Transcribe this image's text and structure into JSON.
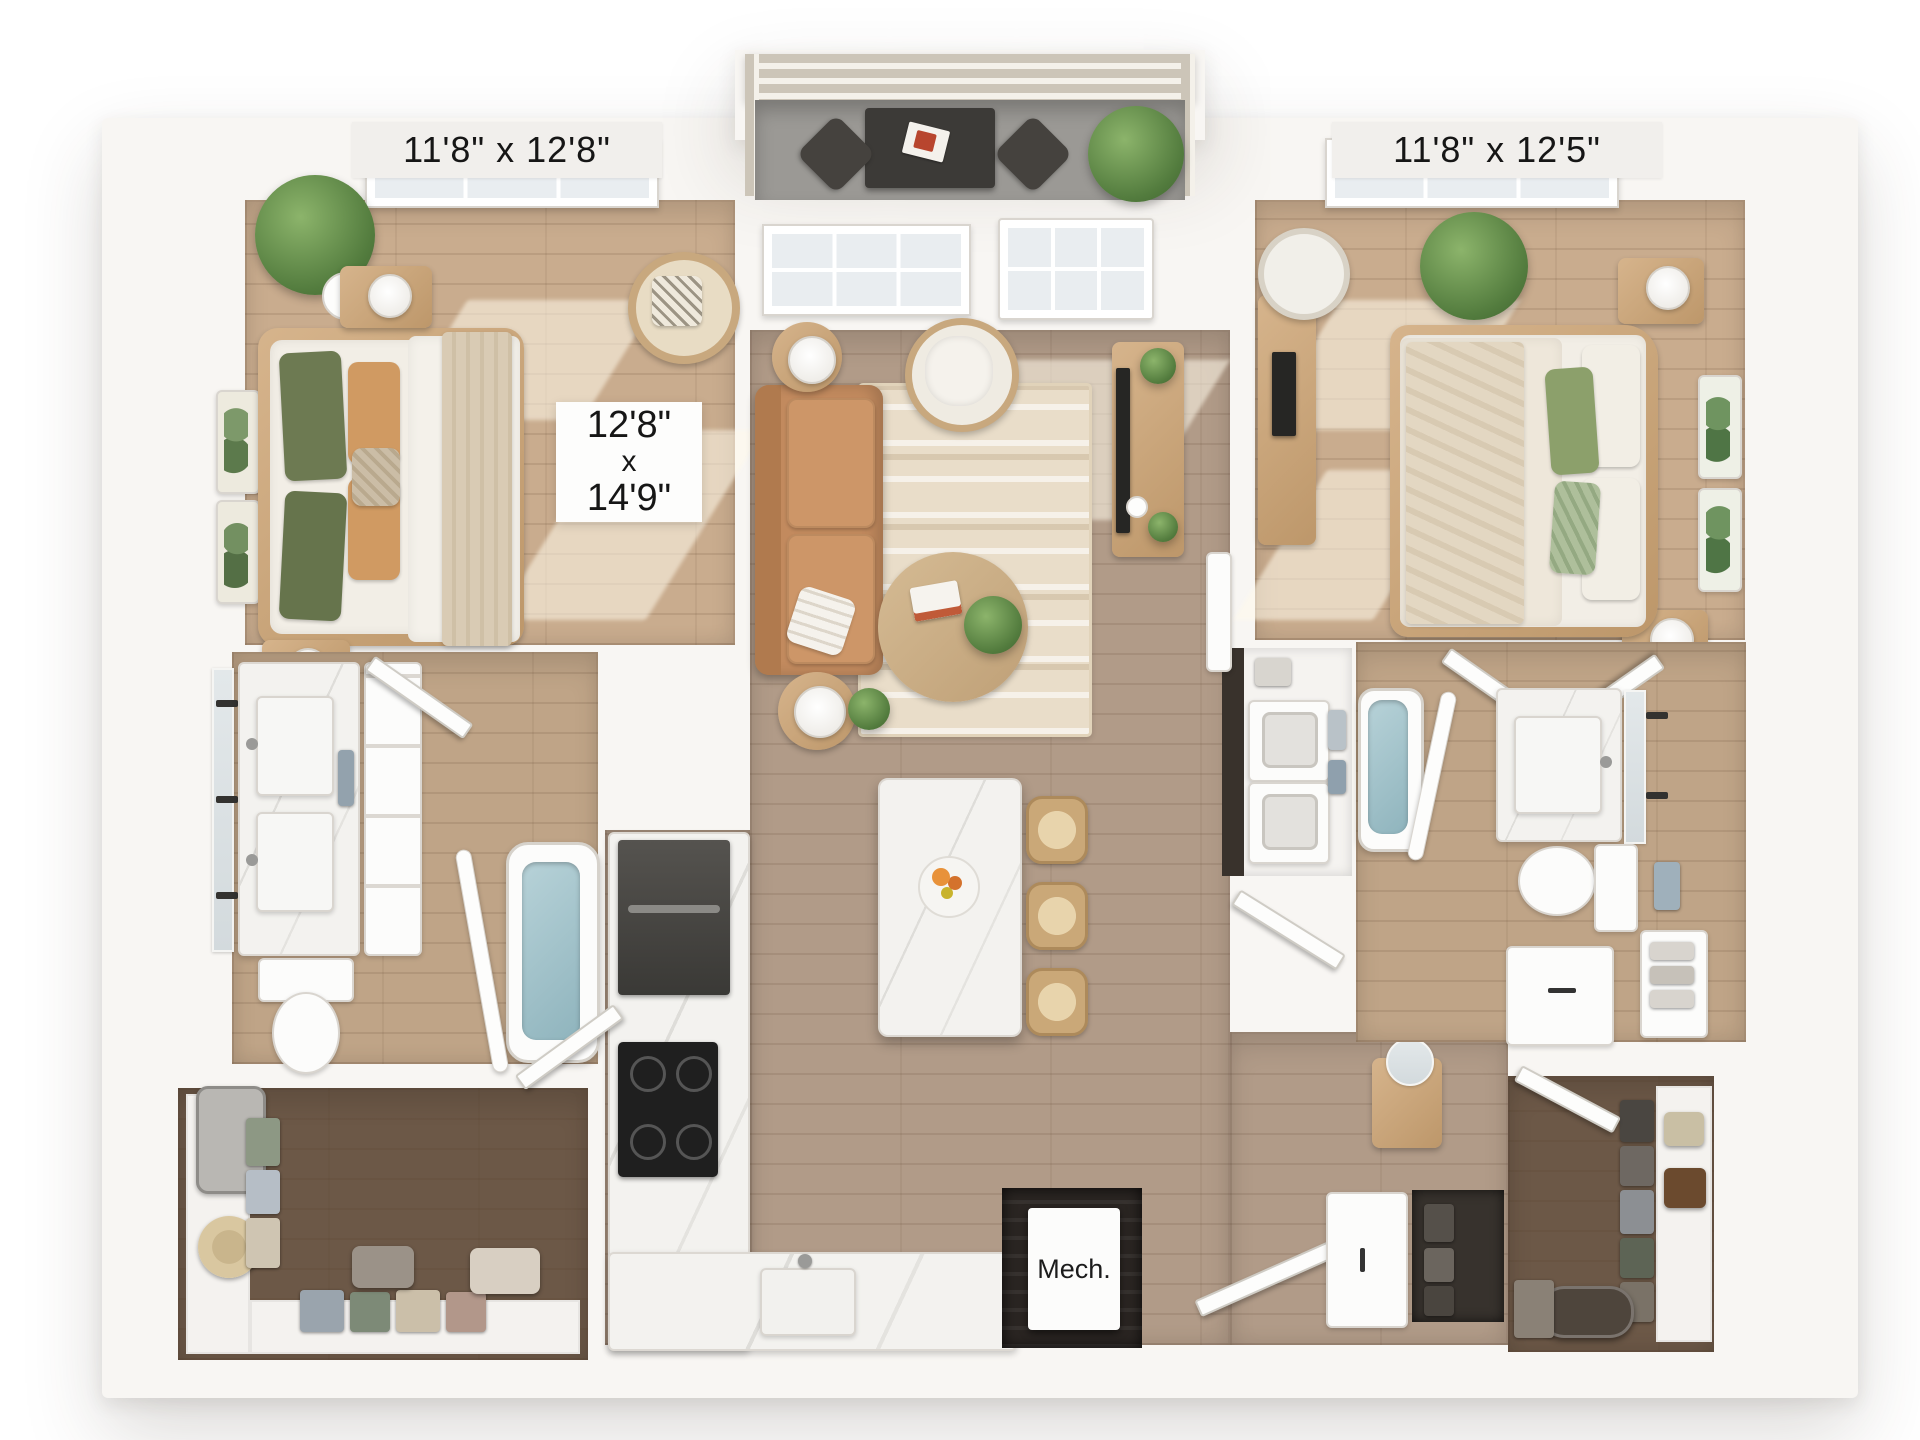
{
  "labels": {
    "bedroom_left_dims": "11'8\" x 12'8\"",
    "bedroom_right_dims": "11'8\" x 12'5\"",
    "living_dims": [
      "12'8\"",
      "x",
      "14'9\""
    ],
    "mech": "Mech."
  },
  "colors": {
    "background": "#ffffff",
    "walls": "#f8f6f3",
    "warm_wood_floor": "#c9ac8e",
    "neutral_wood_floor": "#b19b88",
    "bath_wood_floor": "#bfa487",
    "dark_closet_floor": "#6c5847",
    "balcony_floor": "#9b9995",
    "sofa_leather": "#c28a5e",
    "pillow_green": "#6d7a52",
    "plant_green": "#5f8b4a",
    "rug_cream": "#e9ddc9",
    "marble_counter": "#f3f2ef",
    "appliance_dark": "#3a3936",
    "tub_water": "#a9c6ce",
    "label_text": "#161616"
  }
}
